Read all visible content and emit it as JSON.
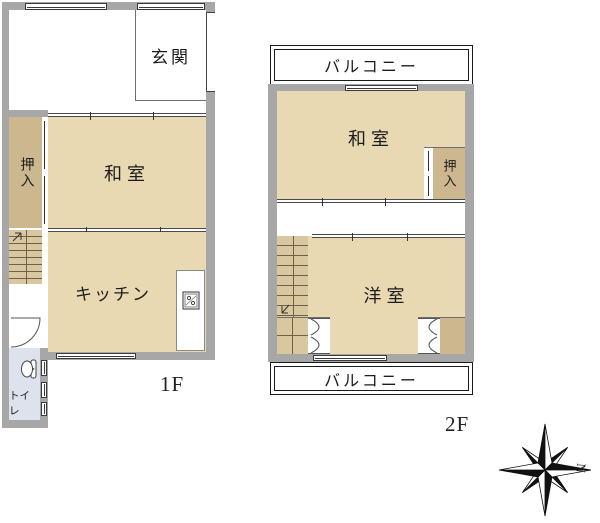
{
  "floor1": {
    "floor_label": "1F",
    "genkan": "玄関",
    "oshiire": "押入",
    "washitsu": "和室",
    "kitchen": "キッチン",
    "toilet": "トイレ"
  },
  "floor2": {
    "floor_label": "2F",
    "balcony_top": "バルコニー",
    "balcony_bottom": "バルコニー",
    "washitsu": "和室",
    "oshiire": "押入",
    "western_room": "洋室"
  },
  "compass": {
    "north_label": "N"
  },
  "icons": [
    "stove-icon",
    "toilet-icon",
    "door-swing-icon",
    "bifold-door-icon",
    "stair-arrow-icon",
    "compass-rose-icon"
  ],
  "colors": {
    "wall": "#a7a7a7",
    "tatami_room": "#e9d9b2",
    "closet": "#cdb78e",
    "stairs": "#d9c89f",
    "toilet": "#dde2ec",
    "balcony_border": "#1a1a1a",
    "text": "#1c1c1c"
  }
}
